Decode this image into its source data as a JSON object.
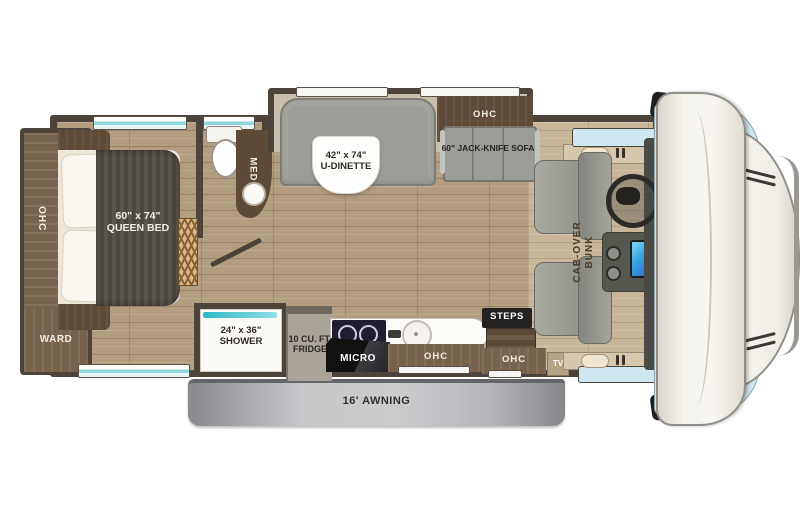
{
  "title": "Class C motorhome floor plan",
  "labels": {
    "ohc_bedroom": "OHC",
    "ward": "WARD",
    "bed_size": "60\" x 74\"",
    "bed_name": "QUEEN BED",
    "med": "MED",
    "dinette_size": "42\" x 74\"",
    "dinette_name": "U-DINETTE",
    "ohc_sofa": "OHC",
    "sofa": "60\" JACK-KNIFE SOFA",
    "shower_size": "24\" x 36\"",
    "shower_name": "SHOWER",
    "fridge_line1": "10 CU. FT.",
    "fridge_line2": "FRIDGE",
    "micro": "MICRO",
    "ohc_kitchen": "OHC",
    "steps": "STEPS",
    "ohc_entry": "OHC",
    "tv": "TV",
    "bunk_line1": "CAB-OVER",
    "bunk_line2": "BUNK",
    "awning": "16' AWNING"
  },
  "colors": {
    "wall": "#4c443a",
    "floor": "#b29d7f",
    "cabinet": "#77624b",
    "darkbrown": "#5d4a37",
    "teal": "#35c4cc",
    "awning_light": "#c6c7c9",
    "awning_dark": "#8e9094",
    "screen_blue": "#2f7fd4",
    "nose_white": "#f5f3ed",
    "window_blue": "#cfe7ee",
    "mattress_gray": "#55504a",
    "bench_gray": "#9c9d98"
  }
}
